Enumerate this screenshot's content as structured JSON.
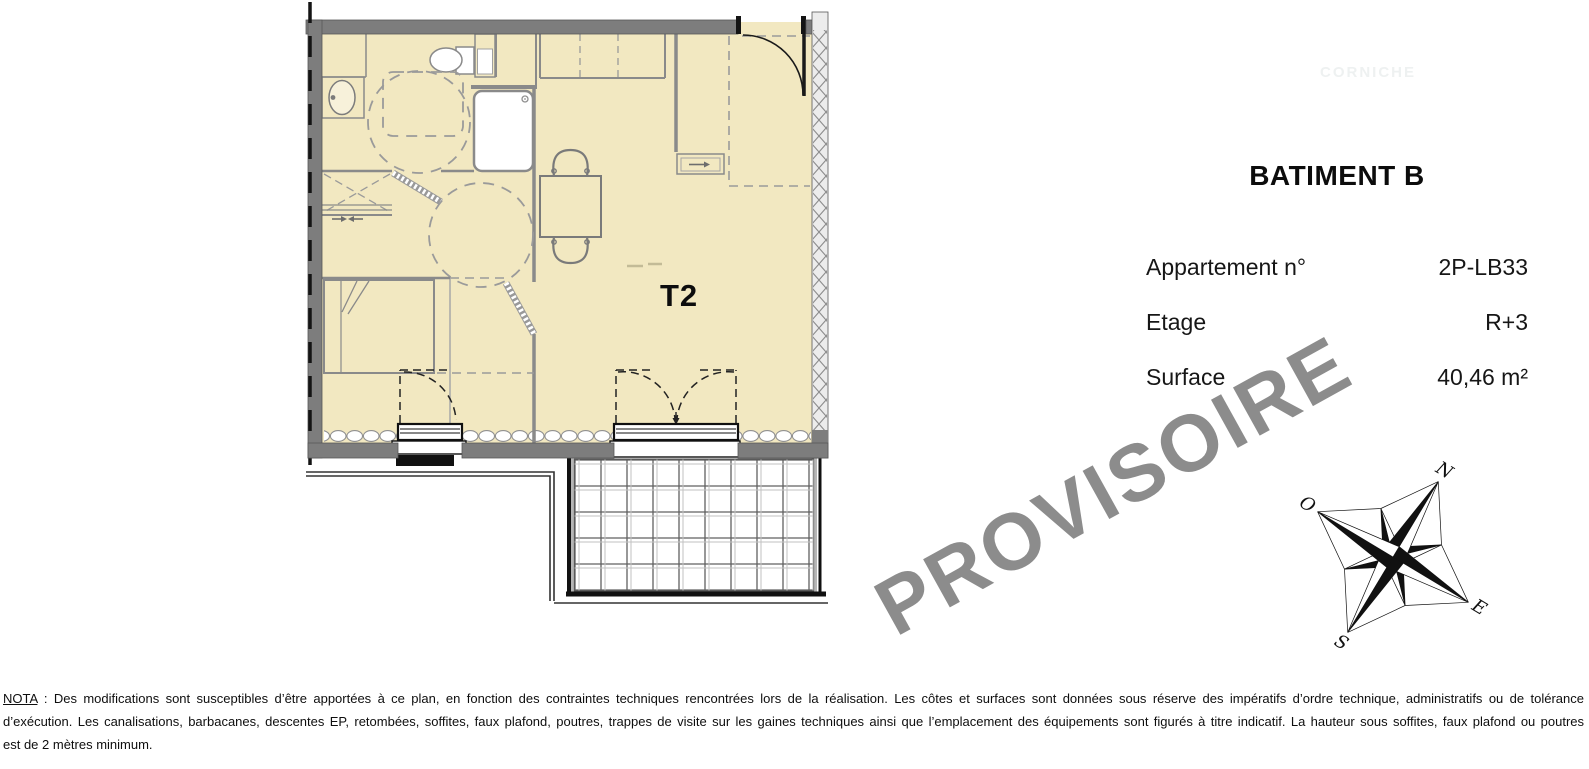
{
  "plan": {
    "unit_label": "T2",
    "compass": {
      "north": "N",
      "west": "O",
      "east": "E",
      "south": "S"
    }
  },
  "info_panel": {
    "building_title": "BATIMENT B",
    "rows": [
      {
        "label": "Appartement n°",
        "value": "2P-LB33"
      },
      {
        "label": "Etage",
        "value": "R+3"
      },
      {
        "label": "Surface",
        "value": "40,46 m²"
      }
    ]
  },
  "watermark": {
    "text": "PROVISOIRE",
    "color": "#8c8c8c"
  },
  "ghost_logo": {
    "text": "CORNICHE"
  },
  "nota": {
    "label": "NOTA",
    "line1_rest": " : Des modifications sont susceptibles d’être apportées à ce plan, en fonction des contraintes techniques rencontrées lors de la réalisation. Les côtes et surfaces sont données sous réserve des impératifs d’ordre technique, administratifs ou de tolérance",
    "line2": "d’exécution. Les canalisations, barbacanes, descentes EP, retombées, soffites, faux plafond, poutres, trappes de visite sur les gaines techniques ainsi que l’emplacement des équipements sont figurés à titre indicatif. La hauteur sous soffites, faux plafond ou poutres",
    "line3": "est de 2 mètres minimum."
  },
  "colors": {
    "floor_fill": "#f2e8c1",
    "wall_gray": "#7d7d7d",
    "watermark_gray": "#8c8c8c"
  }
}
